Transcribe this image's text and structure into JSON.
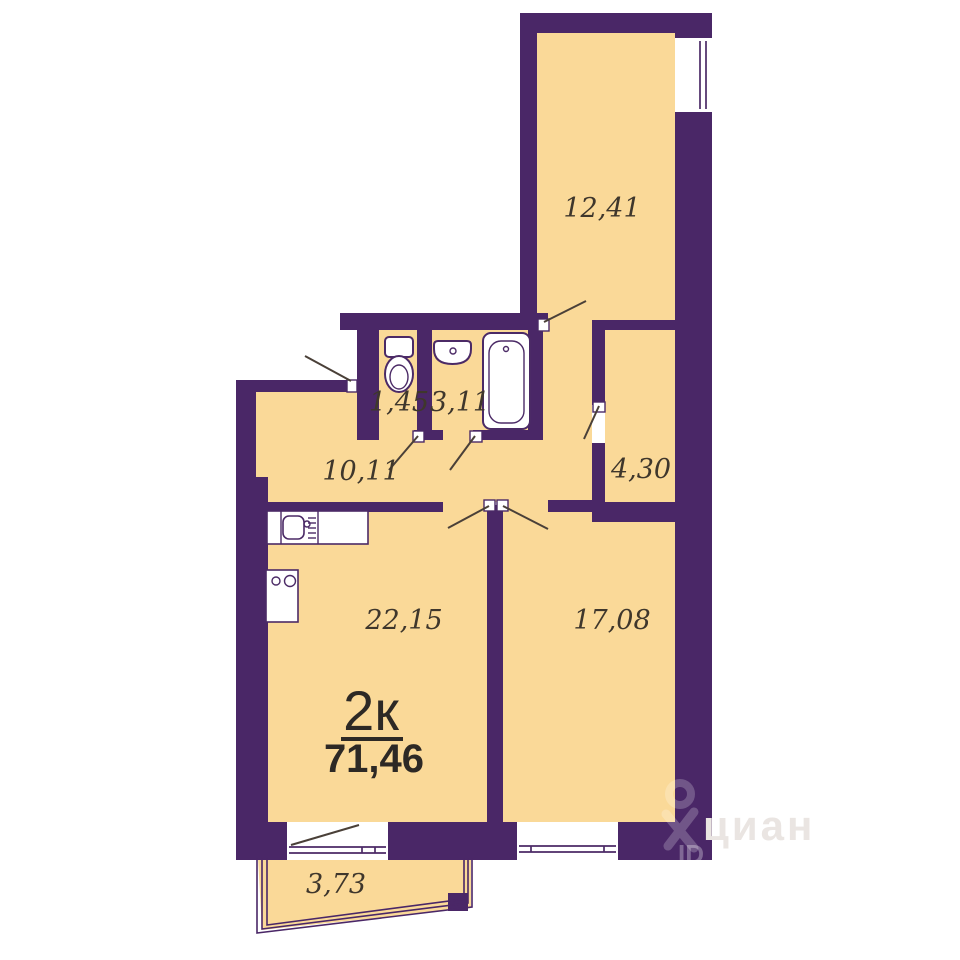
{
  "plan": {
    "type": "apartment-floor-plan",
    "summary": {
      "rooms_label": "2к",
      "total_area": "71,46"
    },
    "rooms": [
      {
        "name": "room-upper",
        "area": "12,41"
      },
      {
        "name": "wc",
        "area": "1,45"
      },
      {
        "name": "bathroom",
        "area": "3,11"
      },
      {
        "name": "hallway",
        "area": "10,11"
      },
      {
        "name": "corridor",
        "area": "4,30"
      },
      {
        "name": "kitchen-living",
        "area": "22,15"
      },
      {
        "name": "bedroom",
        "area": "17,08"
      },
      {
        "name": "balcony",
        "area": "3,73"
      }
    ],
    "fixtures": [
      "toilet",
      "wash-basin",
      "bathtub",
      "kitchen-sink",
      "stove"
    ],
    "watermark": {
      "brand": "циан",
      "badge": "ID"
    },
    "colors": {
      "wall": "#4a2767",
      "floor": "#fad998",
      "background": "#ffffff",
      "label_text": "#3f372c",
      "title_text": "#2d2925"
    }
  }
}
